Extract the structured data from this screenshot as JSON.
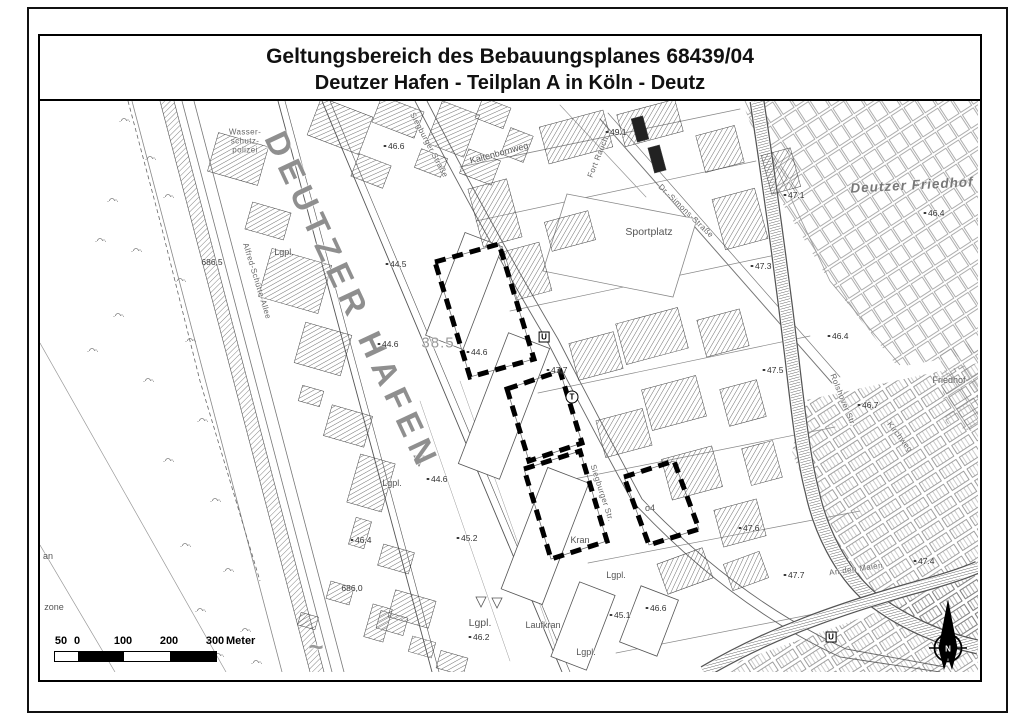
{
  "title": {
    "line1": "Geltungsbereich des Bebauungsplanes 68439/04",
    "line2": "Deutzer Hafen - Teilplan A in Köln - Deutz"
  },
  "scale_bar": {
    "marks": [
      {
        "t": "50",
        "x": 7
      },
      {
        "t": "0",
        "x": 23
      },
      {
        "t": "100",
        "x": 69
      },
      {
        "t": "200",
        "x": 115
      },
      {
        "t": "300",
        "x": 161
      }
    ],
    "unit": "Meter",
    "segments": [
      {
        "w": 23,
        "c": "#ffffff"
      },
      {
        "w": 46,
        "c": "#000000"
      },
      {
        "w": 46,
        "c": "#ffffff"
      },
      {
        "w": 46,
        "c": "#000000"
      }
    ]
  },
  "north_arrow": {
    "label": "N"
  },
  "colors": {
    "frame": "#000000",
    "map_text": "#555555",
    "building_hatch": "#444444",
    "harbor_label": "#8f8f8f",
    "boundary": "#000000"
  },
  "map": {
    "labels": [
      {
        "t": "DEUTZER HAFEN",
        "x": 312,
        "y": 200,
        "r": 65,
        "k": "huge"
      },
      {
        "t": "Wasser-",
        "x": 205,
        "y": 31,
        "k": "tiny"
      },
      {
        "t": "schutz-",
        "x": 205,
        "y": 40,
        "k": "tiny"
      },
      {
        "t": "polizei",
        "x": 205,
        "y": 49,
        "k": "tiny"
      },
      {
        "t": "Lgpl.",
        "x": 244,
        "y": 151,
        "k": "name"
      },
      {
        "t": "686,5",
        "x": 172,
        "y": 161,
        "k": "num"
      },
      {
        "t": "44.5",
        "x": 356,
        "y": 163,
        "k": "spot"
      },
      {
        "t": "46.6",
        "x": 354,
        "y": 45,
        "k": "spot"
      },
      {
        "t": "Siegburger Straße",
        "x": 389,
        "y": 44,
        "r": 62,
        "k": "tiny"
      },
      {
        "t": "Kaltenbornweg",
        "x": 459,
        "y": 52,
        "r": -15,
        "k": "name"
      },
      {
        "t": "49.1",
        "x": 576,
        "y": 31,
        "k": "spot"
      },
      {
        "t": "Fort Rauch",
        "x": 558,
        "y": 56,
        "r": -68,
        "k": "tiny"
      },
      {
        "t": "Dr.-Simons-Straße",
        "x": 646,
        "y": 110,
        "r": 44,
        "k": "tiny"
      },
      {
        "t": "Sportplatz",
        "x": 609,
        "y": 131,
        "k": "name2"
      },
      {
        "t": "Deutzer Friedhof",
        "x": 872,
        "y": 84,
        "r": -3,
        "k": "area"
      },
      {
        "t": "47.1",
        "x": 754,
        "y": 94,
        "k": "spot"
      },
      {
        "t": "46.4",
        "x": 894,
        "y": 112,
        "k": "spot"
      },
      {
        "t": "47.3",
        "x": 721,
        "y": 165,
        "k": "spot"
      },
      {
        "t": "Alfred-Schütte-Allee",
        "x": 217,
        "y": 180,
        "r": 73,
        "k": "tiny"
      },
      {
        "t": "38.5",
        "x": 398,
        "y": 242,
        "k": "bignum"
      },
      {
        "t": "44.6",
        "x": 348,
        "y": 243,
        "k": "spot"
      },
      {
        "t": "44.6",
        "x": 437,
        "y": 251,
        "k": "spot"
      },
      {
        "t": "U",
        "x": 504,
        "y": 236,
        "k": "u"
      },
      {
        "t": "47.7",
        "x": 517,
        "y": 269,
        "k": "spot"
      },
      {
        "t": "T",
        "x": 532,
        "y": 296,
        "k": "t"
      },
      {
        "t": "46.4",
        "x": 798,
        "y": 235,
        "k": "spot"
      },
      {
        "t": "47.5",
        "x": 733,
        "y": 269,
        "k": "spot"
      },
      {
        "t": "Rolshover Str.",
        "x": 803,
        "y": 299,
        "r": 68,
        "k": "tiny"
      },
      {
        "t": "46.7",
        "x": 828,
        "y": 304,
        "k": "spot"
      },
      {
        "t": "Friedhof",
        "x": 909,
        "y": 279,
        "k": "name"
      },
      {
        "t": "Kirchweg",
        "x": 860,
        "y": 336,
        "r": 52,
        "k": "tiny"
      },
      {
        "t": "44.6",
        "x": 397,
        "y": 378,
        "k": "spot"
      },
      {
        "t": "Lgpl.",
        "x": 352,
        "y": 382,
        "k": "name"
      },
      {
        "t": "Siegburger Str.",
        "x": 562,
        "y": 392,
        "r": 72,
        "k": "tiny"
      },
      {
        "t": "46.4",
        "x": 321,
        "y": 439,
        "k": "spot"
      },
      {
        "t": "45.2",
        "x": 427,
        "y": 437,
        "k": "spot"
      },
      {
        "t": "o4",
        "x": 610,
        "y": 407,
        "k": "name"
      },
      {
        "t": "47.6",
        "x": 709,
        "y": 427,
        "k": "spot"
      },
      {
        "t": "Kran",
        "x": 540,
        "y": 439,
        "k": "name"
      },
      {
        "t": "an",
        "x": 8,
        "y": 455,
        "k": "name"
      },
      {
        "t": "686,0",
        "x": 312,
        "y": 487,
        "k": "num"
      },
      {
        "t": "Lgpl.",
        "x": 440,
        "y": 522,
        "k": "name2"
      },
      {
        "t": "Laufkran",
        "x": 503,
        "y": 524,
        "k": "name"
      },
      {
        "t": "45.1",
        "x": 580,
        "y": 514,
        "k": "spot"
      },
      {
        "t": "46.6",
        "x": 616,
        "y": 507,
        "k": "spot"
      },
      {
        "t": "Lgpl.",
        "x": 576,
        "y": 474,
        "k": "name"
      },
      {
        "t": "Lgpl.",
        "x": 546,
        "y": 551,
        "k": "name"
      },
      {
        "t": "46.2",
        "x": 439,
        "y": 536,
        "k": "spot"
      },
      {
        "t": "zone",
        "x": 14,
        "y": 506,
        "k": "name"
      },
      {
        "t": "47.7",
        "x": 754,
        "y": 474,
        "k": "spot"
      },
      {
        "t": "An den Maien",
        "x": 816,
        "y": 468,
        "r": -8,
        "k": "tiny"
      },
      {
        "t": "47.4",
        "x": 884,
        "y": 460,
        "k": "spot"
      },
      {
        "t": "U",
        "x": 791,
        "y": 536,
        "k": "u"
      },
      {
        "t": "~",
        "x": 276,
        "y": 546,
        "k": "flow"
      }
    ]
  }
}
